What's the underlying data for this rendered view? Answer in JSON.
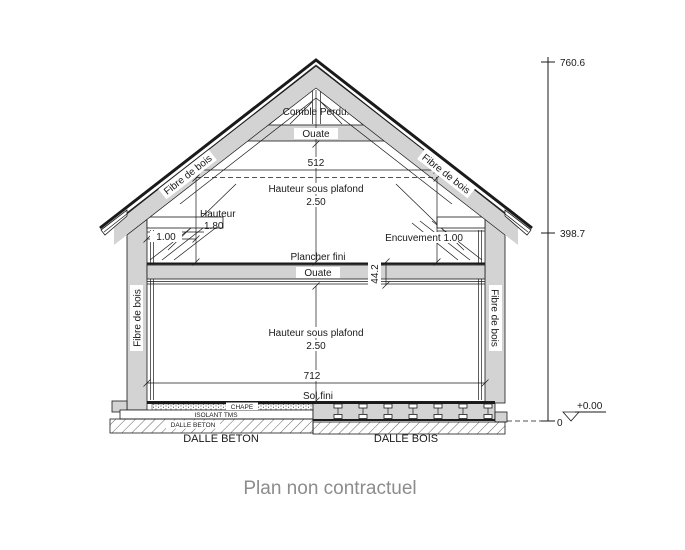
{
  "drawing": {
    "attic": {
      "comble_perdu": "Comble Perdu.",
      "ouate": "Ouate"
    },
    "roof": {
      "fibre_left": "Fibre de bois",
      "fibre_right": "Fibre de bois"
    },
    "walls": {
      "fibre_left": "Fibre de bois",
      "fibre_right": "Fibre de bois"
    },
    "upper_floor": {
      "width_dim": "512",
      "ceiling_label": "Hauteur sous plafond",
      "ceiling_value": "2.50",
      "knee_height_label": "Hauteur",
      "knee_height_value": "1.80",
      "side_offset": "1.00",
      "encuvement": "Encuvement 1.00",
      "floor_label": "Plancher fini",
      "floor_insulation": "Ouate",
      "floor_thickness": "44.2"
    },
    "ground_floor": {
      "ceiling_label": "Hauteur sous plafond",
      "ceiling_value": "2.50",
      "width_dim": "712",
      "floor_label": "Sol fini",
      "screed": "CHAPE",
      "insulation": "ISOLANT TMS",
      "slab": "DALLE BETON"
    },
    "foundations": {
      "left_title": "DALLE BETON",
      "right_title": "DALLE BOIS"
    },
    "elevation": {
      "ridge": "760.6",
      "eave": "398.7",
      "zero": "0",
      "datum": "+0.00"
    }
  },
  "caption": "Plan non contractuel",
  "colors": {
    "line": "#1a1a1a",
    "fill_gray": "#d3d3d3",
    "caption_gray": "#8c8c8c",
    "background": "#ffffff"
  }
}
